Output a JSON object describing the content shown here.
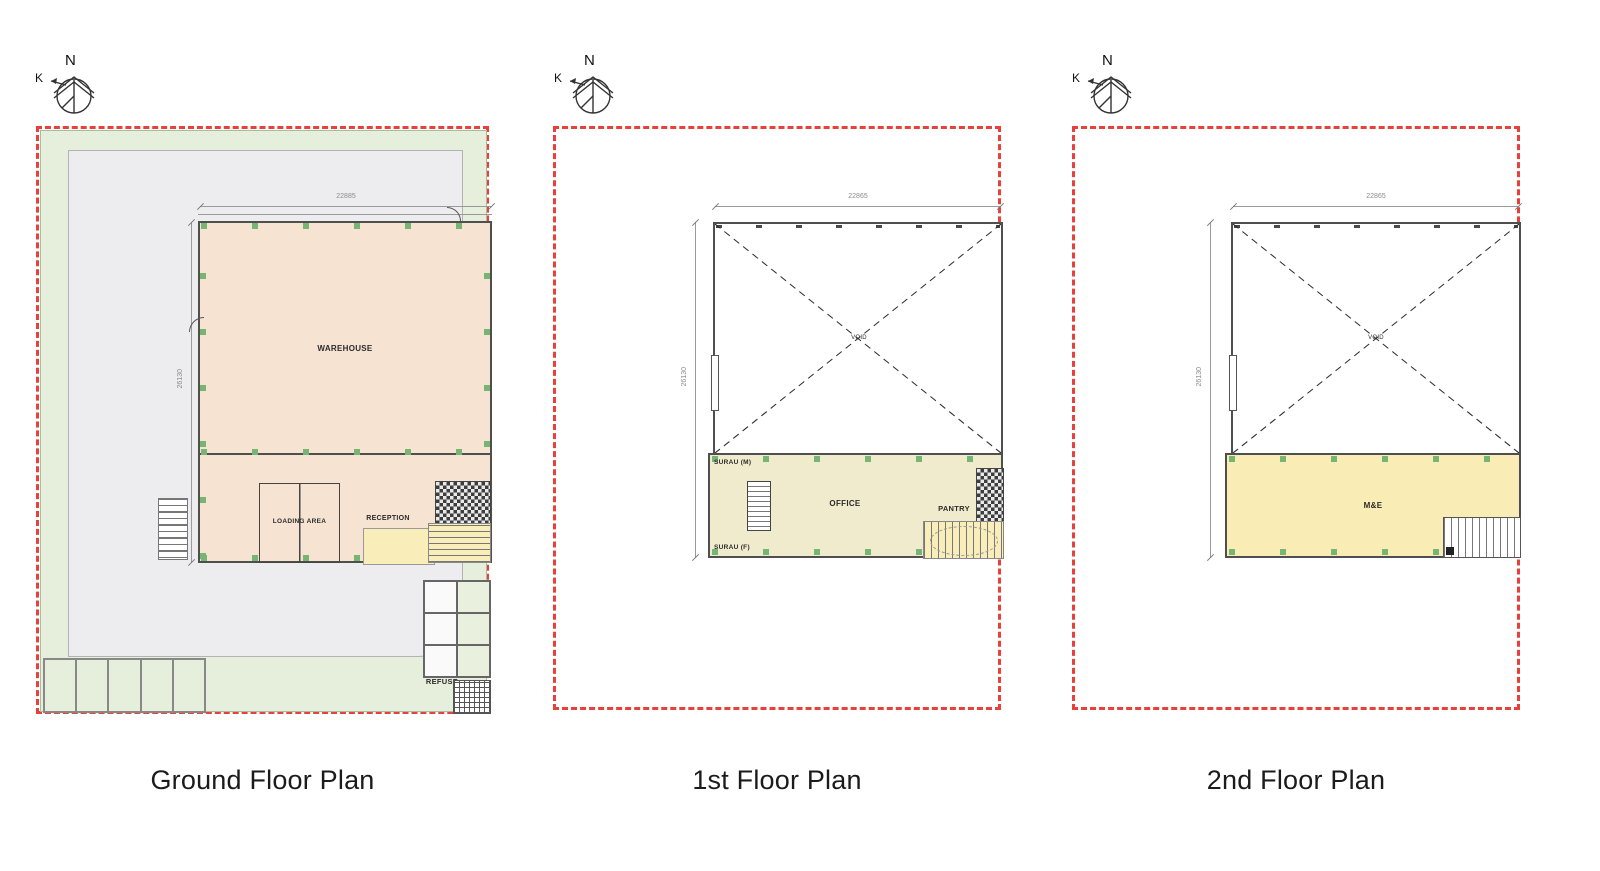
{
  "page": {
    "background": "#ffffff"
  },
  "colors": {
    "boundary_red": "#e8403a",
    "landscape_green": "#e5efdb",
    "hardstand_grey": "#ededef",
    "warehouse_fill": "#f6e3d2",
    "office_fill": "#f0ebcd",
    "stair_yellow": "#f9edb9",
    "me_yellow": "#f9ecb4",
    "column_green": "#76b574",
    "wall_line": "#4f4f4f"
  },
  "plans": [
    {
      "title": "Ground Floor Plan",
      "compass": {
        "north": "N",
        "k": "K"
      },
      "dims": {
        "width": "22885",
        "depth": "26130"
      },
      "rooms": {
        "warehouse": "WAREHOUSE",
        "loading_area": "LOADING AREA",
        "reception": "RECEPTION",
        "refuse": "REFUSE"
      }
    },
    {
      "title": "1st Floor Plan",
      "compass": {
        "north": "N",
        "k": "K"
      },
      "dims": {
        "width": "22865",
        "depth": "26130"
      },
      "rooms": {
        "surau_m": "SURAU (M)",
        "surau_f": "SURAU (F)",
        "office": "OFFICE",
        "pantry": "PANTRY",
        "void": "VOID"
      }
    },
    {
      "title": "2nd Floor Plan",
      "compass": {
        "north": "N",
        "k": "K"
      },
      "dims": {
        "width": "22865",
        "depth": "26130"
      },
      "rooms": {
        "me": "M&E",
        "void": "VOID"
      }
    }
  ]
}
